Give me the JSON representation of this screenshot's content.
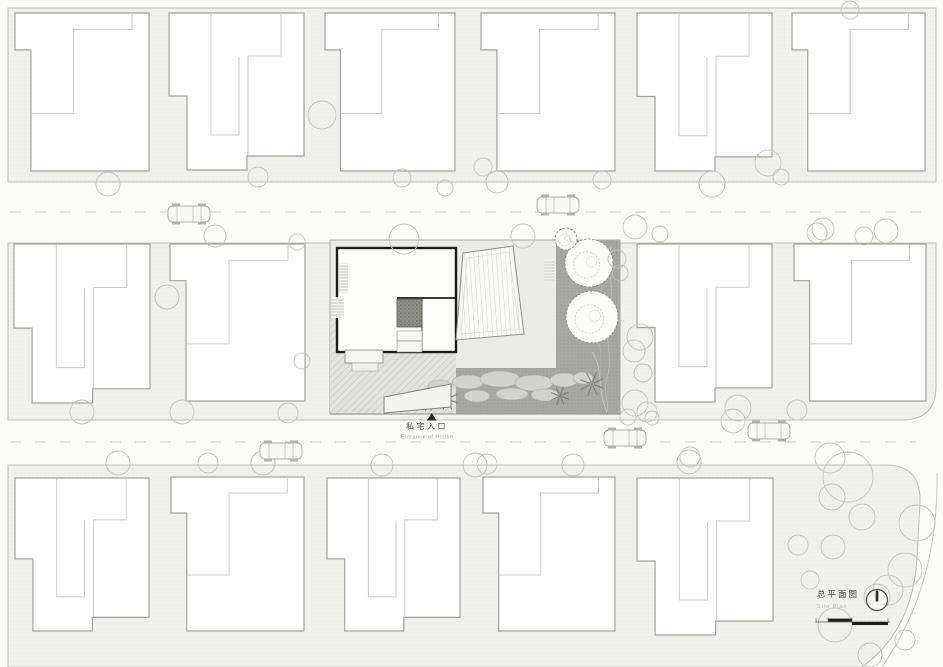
{
  "labels": {
    "entrance_cn": "私宅入口",
    "entrance_en": "Entrance of House",
    "title_cn": "总平面图",
    "title_en": "Site Plan"
  },
  "palette": {
    "page_bg": "#fcfcfb",
    "block_fill": "#f1f1ee",
    "block_dot": "#dcdcd7",
    "block_edge": "#bcbcb7",
    "road_dash": "#c9c9c4",
    "house_fill": "#ffffff",
    "house_stroke": "#a2a29d",
    "house_inner": "#c9c9c4",
    "tree_stroke": "#c2c2bd",
    "wall_dark": "#1c1c1c",
    "garden_gray": "#a7a7a2",
    "marker_black": "#262624"
  },
  "site": {
    "house_types": {
      "A": {
        "w": 135,
        "h": 157,
        "outer": [
          [
            0,
            0
          ],
          [
            135,
            0
          ],
          [
            135,
            143
          ],
          [
            78,
            143
          ],
          [
            78,
            157
          ],
          [
            18,
            157
          ],
          [
            18,
            83
          ],
          [
            0,
            83
          ]
        ],
        "inner": [
          [
            [
              42,
              1
            ],
            [
              42,
              122
            ],
            [
              70,
              122
            ],
            [
              70,
              44
            ]
          ],
          [
            [
              112,
              1
            ],
            [
              112,
              43
            ],
            [
              79,
              43
            ],
            [
              79,
              143
            ]
          ]
        ]
      },
      "B": {
        "w": 135,
        "h": 154,
        "outer": [
          [
            0,
            0
          ],
          [
            135,
            0
          ],
          [
            135,
            154
          ],
          [
            16,
            154
          ],
          [
            16,
            36
          ],
          [
            0,
            36
          ]
        ],
        "inner": [
          [
            [
              118,
              1
            ],
            [
              118,
              16
            ],
            [
              59,
              16
            ],
            [
              59,
              98
            ],
            [
              16,
              98
            ]
          ]
        ]
      }
    },
    "houses": [
      [
        15,
        13,
        134,
        158,
        "B"
      ],
      [
        169,
        13,
        135,
        157,
        "A"
      ],
      [
        325,
        13,
        130,
        158,
        "B"
      ],
      [
        481,
        13,
        134,
        158,
        "B"
      ],
      [
        637,
        13,
        135,
        158,
        "A"
      ],
      [
        792,
        13,
        133,
        158,
        "B"
      ],
      [
        14,
        244,
        136,
        159,
        "A"
      ],
      [
        170,
        244,
        135,
        157,
        "B"
      ],
      [
        637,
        244,
        135,
        158,
        "A"
      ],
      [
        794,
        244,
        132,
        157,
        "B"
      ],
      [
        15,
        478,
        134,
        153,
        "A"
      ],
      [
        171,
        477,
        133,
        154,
        "B"
      ],
      [
        327,
        478,
        133,
        153,
        "A"
      ],
      [
        483,
        477,
        132,
        154,
        "B"
      ],
      [
        637,
        478,
        136,
        157,
        "A"
      ]
    ],
    "trees": [
      [
        108,
        184,
        12
      ],
      [
        215,
        236,
        11
      ],
      [
        258,
        177,
        10
      ],
      [
        297,
        242,
        8
      ],
      [
        322,
        115,
        14
      ],
      [
        402,
        178,
        9
      ],
      [
        404,
        239,
        15
      ],
      [
        445,
        188,
        8
      ],
      [
        483,
        167,
        9
      ],
      [
        497,
        182,
        11
      ],
      [
        523,
        236,
        12
      ],
      [
        602,
        180,
        9
      ],
      [
        635,
        227,
        12
      ],
      [
        660,
        234,
        8
      ],
      [
        712,
        184,
        13
      ],
      [
        768,
        163,
        13
      ],
      [
        781,
        177,
        8
      ],
      [
        823,
        229,
        11
      ],
      [
        850,
        10,
        9
      ],
      [
        864,
        236,
        9
      ],
      [
        886,
        231,
        12
      ],
      [
        167,
        297,
        12
      ],
      [
        82,
        412,
        12
      ],
      [
        182,
        412,
        12
      ],
      [
        288,
        413,
        10
      ],
      [
        302,
        361,
        8
      ],
      [
        617,
        259,
        9
      ],
      [
        620,
        273,
        8
      ],
      [
        640,
        337,
        13
      ],
      [
        634,
        351,
        11
      ],
      [
        643,
        373,
        9
      ],
      [
        635,
        403,
        13
      ],
      [
        647,
        412,
        10
      ],
      [
        738,
        408,
        13
      ],
      [
        797,
        410,
        10
      ],
      [
        817,
        233,
        10
      ],
      [
        628,
        417,
        8
      ],
      [
        652,
        418,
        7
      ],
      [
        733,
        421,
        12
      ],
      [
        690,
        457,
        10
      ],
      [
        118,
        463,
        12
      ],
      [
        208,
        463,
        10
      ],
      [
        263,
        463,
        12
      ],
      [
        382,
        465,
        11
      ],
      [
        475,
        465,
        12
      ],
      [
        487,
        464,
        10
      ],
      [
        573,
        465,
        11
      ],
      [
        689,
        462,
        12
      ],
      [
        830,
        458,
        15
      ],
      [
        848,
        477,
        25
      ],
      [
        832,
        497,
        13
      ],
      [
        862,
        517,
        13
      ],
      [
        917,
        523,
        18
      ],
      [
        833,
        547,
        12
      ],
      [
        798,
        545,
        10
      ],
      [
        905,
        570,
        17
      ],
      [
        810,
        580,
        9
      ],
      [
        888,
        590,
        15
      ],
      [
        877,
        597,
        13
      ],
      [
        835,
        625,
        17
      ],
      [
        905,
        640,
        10
      ],
      [
        870,
        655,
        12
      ]
    ],
    "cars": [
      [
        189,
        214,
        -1
      ],
      [
        558,
        205,
        1
      ],
      [
        625,
        438,
        -1
      ],
      [
        769,
        431,
        1
      ],
      [
        281,
        451,
        -1
      ]
    ],
    "garden_trees": [
      [
        589,
        263,
        24
      ],
      [
        592,
        317,
        26
      ],
      [
        566,
        239,
        11
      ]
    ],
    "palms": [
      [
        447,
        399,
        11
      ],
      [
        560,
        396,
        9
      ],
      [
        592,
        384,
        12
      ],
      [
        428,
        404,
        7
      ]
    ],
    "hedges": [
      [
        468,
        382,
        16,
        7
      ],
      [
        500,
        379,
        20,
        8
      ],
      [
        534,
        383,
        19,
        8
      ],
      [
        564,
        380,
        14,
        7
      ],
      [
        477,
        396,
        13,
        6
      ],
      [
        512,
        394,
        16,
        6
      ],
      [
        545,
        395,
        14,
        6
      ],
      [
        583,
        378,
        10,
        6
      ],
      [
        440,
        386,
        12,
        6
      ]
    ],
    "stairs": [
      [
        339,
        263,
        9,
        30
      ],
      [
        544,
        259,
        10,
        22
      ],
      [
        331,
        297,
        13,
        21
      ]
    ]
  }
}
